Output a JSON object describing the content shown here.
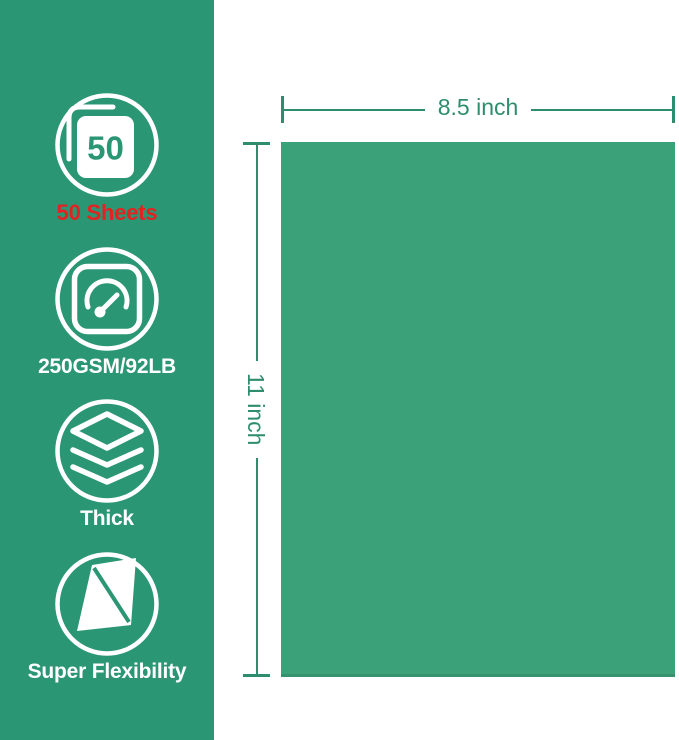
{
  "colors": {
    "sidebar_green": "#2b9674",
    "paper_green": "#3aa179",
    "dim_green": "#2e8d6e",
    "sheets_red": "#e32221",
    "icon_white": "#ffffff"
  },
  "sidebar": {
    "features": [
      {
        "icon": "sheet-stack-50-icon",
        "badge_number": "50",
        "label": "50 Sheets"
      },
      {
        "icon": "speedometer-icon",
        "label": "250GSM/92LB"
      },
      {
        "icon": "layers-icon",
        "label": "Thick"
      },
      {
        "icon": "bent-paper-icon",
        "label": "Super Flexibility"
      }
    ]
  },
  "diagram": {
    "paper": {
      "width_label": "8.5 inch",
      "height_label": "11 inch"
    }
  }
}
